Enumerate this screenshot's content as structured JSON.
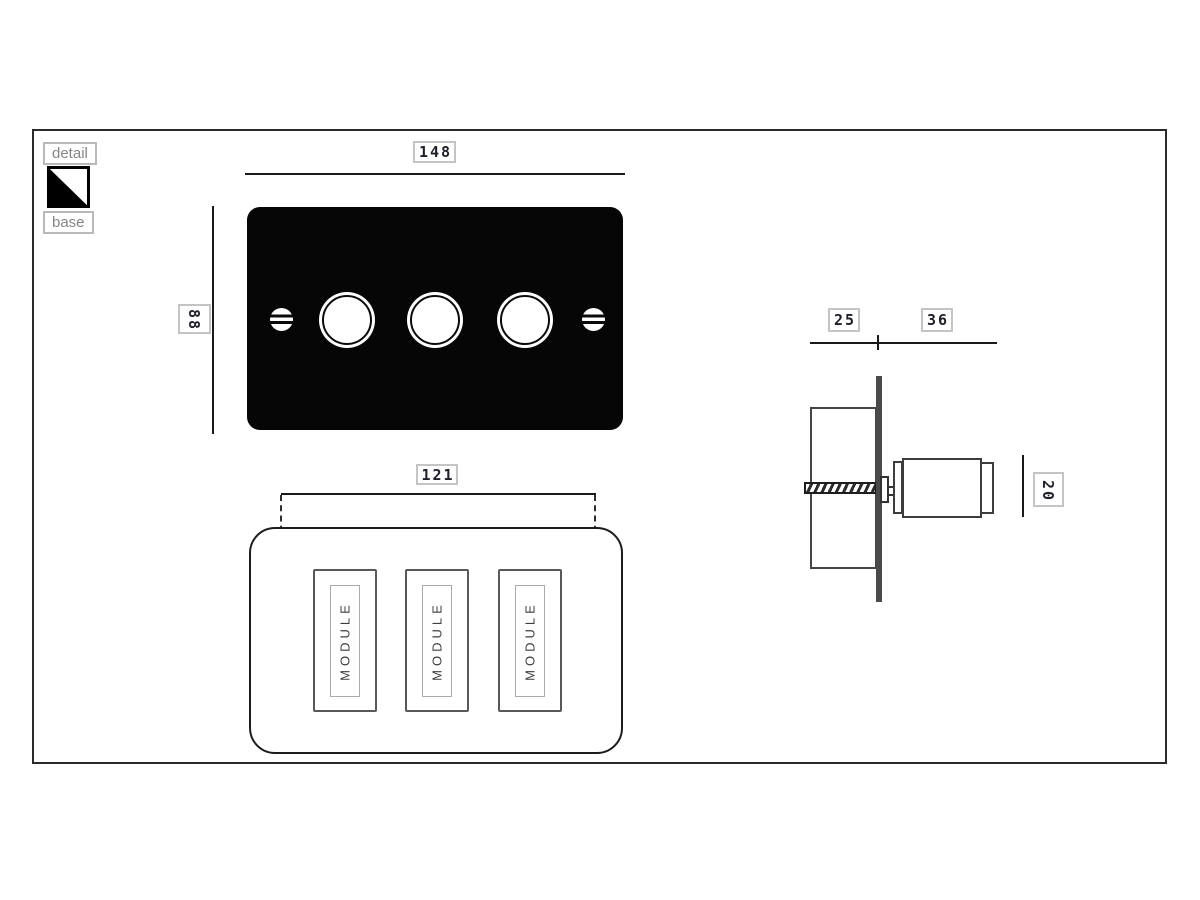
{
  "drawing": {
    "legend": {
      "detail_label": "detail",
      "base_label": "base",
      "swatch": {
        "primary_color": "#000000",
        "secondary_color": "#ffffff"
      }
    },
    "front_view": {
      "width_dim": "148",
      "height_dim": "88"
    },
    "rear_view": {
      "fixing_centres_dim": "121",
      "modules": [
        {
          "label": "MODULE"
        },
        {
          "label": "MODULE"
        },
        {
          "label": "MODULE"
        }
      ]
    },
    "side_view": {
      "box_depth_dim": "25",
      "projection_dim": "36",
      "knob_height_dim": "20"
    },
    "colors": {
      "plate": "#060606",
      "line": "#1a1a1a",
      "dim_box_border": "#c4c4c4",
      "chip_text": "#858585"
    }
  }
}
